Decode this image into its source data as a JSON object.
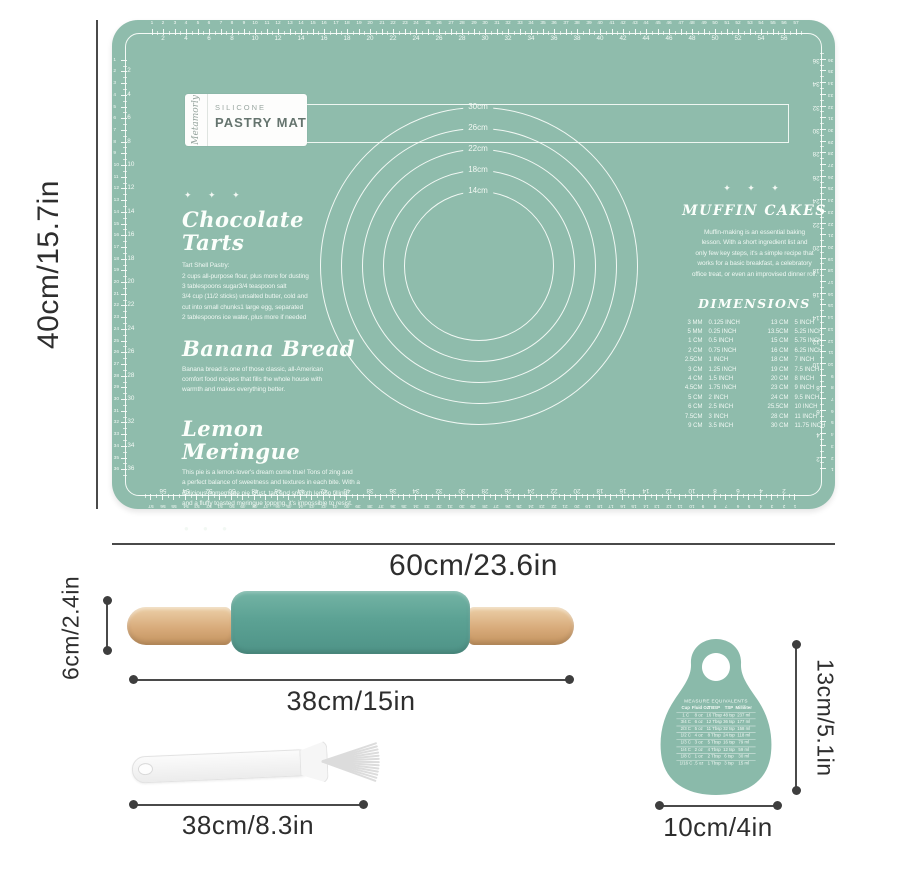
{
  "colors": {
    "mat": "#8FBCAC",
    "ink": "#F2F8F3",
    "pin": "#5CA294",
    "scraper": "#8ABAAA",
    "dim": "#4A4A4A"
  },
  "mat": {
    "logo": {
      "brand": "Metamorly",
      "reg": "®",
      "line1": "SILICONE",
      "line2": "PASTRY MAT"
    },
    "markers": {
      "diamonds": "✦ ✦ ✦",
      "dots": "● ● ●"
    },
    "circles": {
      "labels": [
        "30cm",
        "26cm",
        "22cm",
        "18cm",
        "14cm"
      ]
    },
    "ruler": {
      "top": 57,
      "bottom": 57,
      "left": 36,
      "right": 36
    },
    "recipes": [
      {
        "title": "Chocolate Tarts",
        "body": "Tart Shell Pastry:\n2 cups all-purpose flour, plus more for dusting\n3 tablespoons sugar3/4 teaspoon salt\n3/4 cup (11/2 sticks) unsalted butter, cold and\ncut into small chunks1 large egg, separated\n2 tablespoons ice water, plus more if needed"
      },
      {
        "title": "Banana Bread",
        "body": "Banana bread is one of those classic, all-American\ncomfort food recipes that fills the whole house with\nwarmth and makes everything better."
      },
      {
        "title": "Lemon Meringue",
        "body": "This pie is a lemon-lover's dream come true! Tons of zing and\na perfect balance of sweetness and textures in each bite. With a\ndelicious homemade pie crust, tart and smooth lemon filling,\nand a fluffy toasted meringue topping, it's impossible to resist."
      }
    ],
    "muffin": {
      "title": "MUFFIN CAKES",
      "body": "Muffin-making is an essential baking\nlesson. With a short ingredient list and\nonly few key steps, it's a simple recipe that\nworks for a basic breakfast, a celebratory\noffice treat, or even an improvised dinner roll."
    },
    "dimensions_table": {
      "title": "DIMENSIONS",
      "rows": [
        [
          "3 MM",
          "0.125 INCH",
          "13 CM",
          "5 INCH"
        ],
        [
          "5 MM",
          "0.25 INCH",
          "13.5CM",
          "5.25 INCH"
        ],
        [
          "1 CM",
          "0.5 INCH",
          "15 CM",
          "5.75 INCH"
        ],
        [
          "2 CM",
          "0.75 INCH",
          "16 CM",
          "6.25 INCH"
        ],
        [
          "2.5CM",
          "1 INCH",
          "18 CM",
          "7 INCH"
        ],
        [
          "3 CM",
          "1.25 INCH",
          "19 CM",
          "7.5 INCH"
        ],
        [
          "4 CM",
          "1.5 INCH",
          "20 CM",
          "8 INCH"
        ],
        [
          "4.5CM",
          "1.75 INCH",
          "23 CM",
          "9 INCH"
        ],
        [
          "5 CM",
          "2 INCH",
          "24 CM",
          "9.5 INCH"
        ],
        [
          "6 CM",
          "2.5 INCH",
          "25.5CM",
          "10 INCH"
        ],
        [
          "7.5CM",
          "3 INCH",
          "28 CM",
          "11 INCH"
        ],
        [
          "9 CM",
          "3.5 INCH",
          "30 CM",
          "11.75 INCH"
        ]
      ]
    }
  },
  "scraper": {
    "title": "MEASURE EQUIVALENTS",
    "headers": [
      "Cup",
      "Fluid OZ",
      "TBSP",
      "TSP",
      "Milliliter"
    ],
    "rows": [
      [
        "1 C",
        "8 oz",
        "16 Tbsp",
        "48 tsp",
        "237 ml"
      ],
      [
        "3/4 C",
        "6 oz",
        "12 Tbsp",
        "36 tsp",
        "177 ml"
      ],
      [
        "2/3 C",
        "5 oz",
        "11 Tbsp",
        "32 tsp",
        "158 ml"
      ],
      [
        "1/2 C",
        "4 oz",
        "8 Tbsp",
        "24 tsp",
        "118 ml"
      ],
      [
        "1/3 C",
        "3 oz",
        "5 Tbsp",
        "16 tsp",
        "79 ml"
      ],
      [
        "1/4 C",
        "2 oz",
        "4 Tbsp",
        "12 tsp",
        "59 ml"
      ],
      [
        "1/8 C",
        "1 oz",
        "2 Tbsp",
        "6 tsp",
        "30 ml"
      ],
      [
        "1/16 C",
        ".5 oz",
        "1 Tbsp",
        "3 tsp",
        "15 ml"
      ]
    ]
  },
  "annotations": {
    "mat_height": "40cm/15.7in",
    "mat_width": "60cm/23.6in",
    "pin_height": "6cm/2.4in",
    "pin_length": "38cm/15in",
    "brush_length": "38cm/8.3in",
    "scraper_height": "13cm/5.1in",
    "scraper_width": "10cm/4in"
  }
}
